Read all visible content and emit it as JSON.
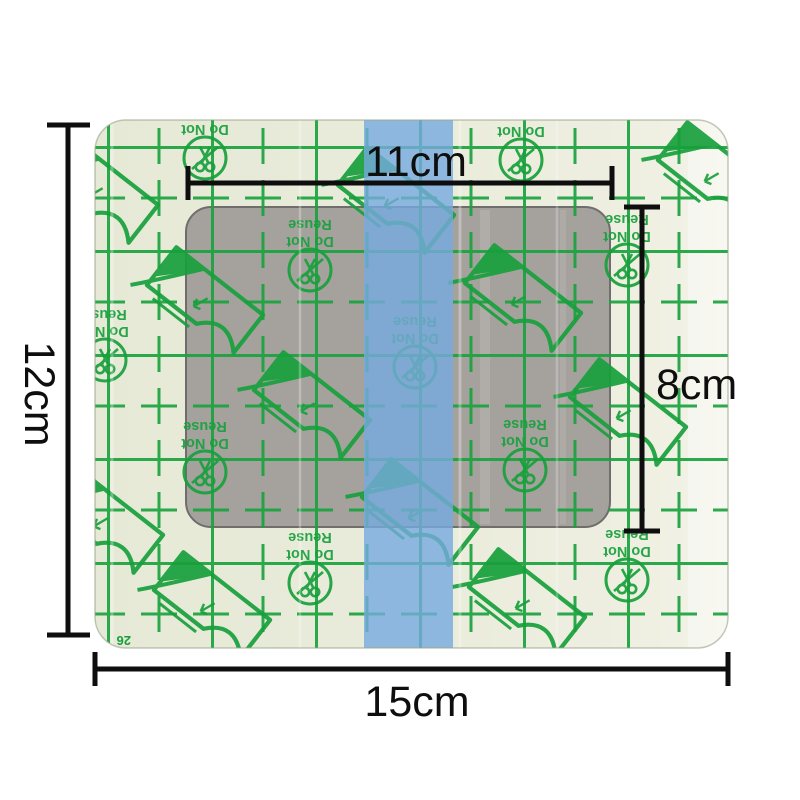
{
  "scene": {
    "background": "#ffffff",
    "subject": "transparent adhesive film wound dressing with size annotations"
  },
  "dressing": {
    "film_color": "#e9ebda",
    "film_highlight": "#f6f6ee",
    "print_color": "#1aa23e",
    "pad_color": "#a5a29e",
    "stripe_color": "#76aade",
    "print_warning": {
      "line1": "Do Not",
      "line2": "Reuse"
    },
    "liner_code": "26",
    "icons": {
      "no_scissors": "circle with crossed-out scissors (do not cut)",
      "peel_liner": "tilted film with peeled corner and arrow"
    }
  },
  "dimensions": {
    "color": "#0e0e0e",
    "outer_width": "15cm",
    "outer_height": "12cm",
    "film_window_width": "11cm",
    "pad_height": "8cm"
  }
}
